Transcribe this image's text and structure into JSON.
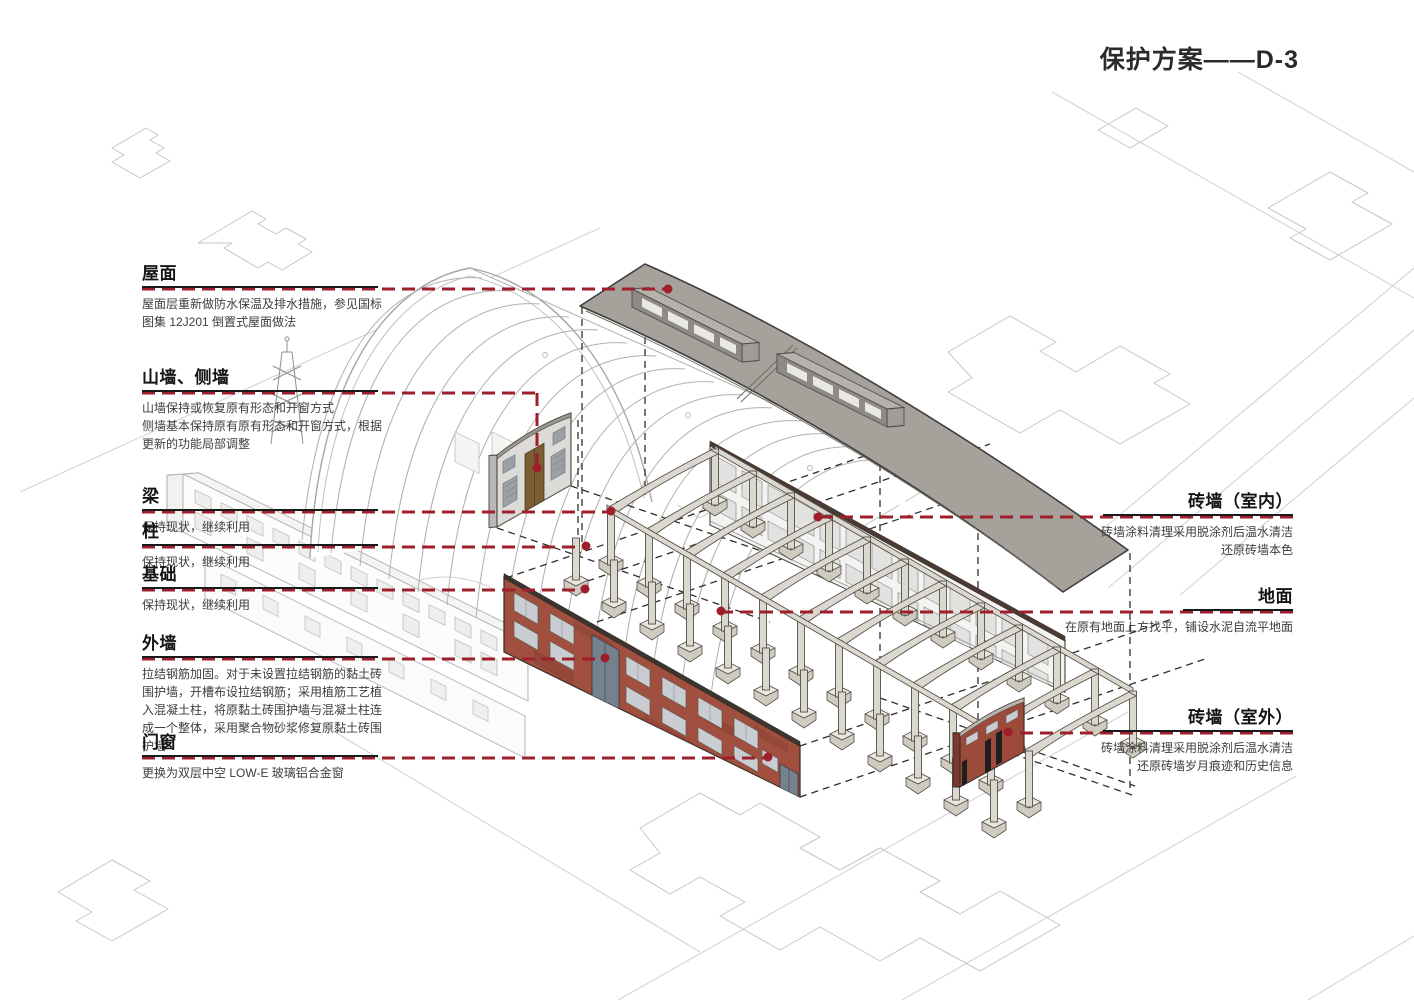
{
  "page_title": "保护方案——D-3",
  "colors": {
    "accent_red": "#9e1f2b",
    "roof_gray": "#a6a29b",
    "brick_red": "#a1503f",
    "frame_gray": "#dbd8cf",
    "door_brown": "#7a5e32",
    "door_blue": "#76818f",
    "context_gray": "#c6c6c6"
  },
  "labels_left": [
    {
      "id": "roof",
      "title": "屋面",
      "desc": [
        "屋面层重新做防水保温及排水措施，参见国标",
        "图集 12J201 倒置式屋面做法"
      ]
    },
    {
      "id": "gable-side-walls",
      "title": "山墙、侧墙",
      "desc": [
        "山墙保持或恢复原有形态和开窗方式",
        "侧墙基本保持原有原有形态和开窗方式，根据",
        "更新的功能局部调整"
      ]
    },
    {
      "id": "beam",
      "title": "梁",
      "desc": [
        "保持现状，继续利用"
      ]
    },
    {
      "id": "column",
      "title": "柱",
      "desc": [
        "保持现状，继续利用"
      ]
    },
    {
      "id": "foundation",
      "title": "基础",
      "desc": [
        "保持现状，继续利用"
      ]
    },
    {
      "id": "exterior-wall",
      "title": "外墙",
      "desc": [
        "拉结钢筋加固。对于未设置拉结钢筋的黏土砖",
        "围护墙，开槽布设拉结钢筋；采用植筋工艺植",
        "入混凝土柱，将原黏土砖围护墙与混凝土柱连",
        "成一个整体，采用聚合物砂浆修复原黏土砖围",
        "护墙"
      ]
    },
    {
      "id": "doors-windows",
      "title": "门窗",
      "desc": [
        "更换为双层中空 LOW-E 玻璃铝合金窗"
      ]
    }
  ],
  "labels_right": [
    {
      "id": "brick-wall-interior",
      "title": "砖墙（室内）",
      "desc": [
        "砖墙涂料清理采用脱涂剂后温水清洁",
        "还原砖墙本色"
      ]
    },
    {
      "id": "ground",
      "title": "地面",
      "desc": [
        "在原有地面上方找平，铺设水泥自流平地面"
      ]
    },
    {
      "id": "brick-wall-exterior",
      "title": "砖墙（室外）",
      "desc": [
        "砖墙涂料清理采用脱涂剂后温水清洁",
        "还原砖墙岁月痕迹和历史信息"
      ]
    }
  ]
}
